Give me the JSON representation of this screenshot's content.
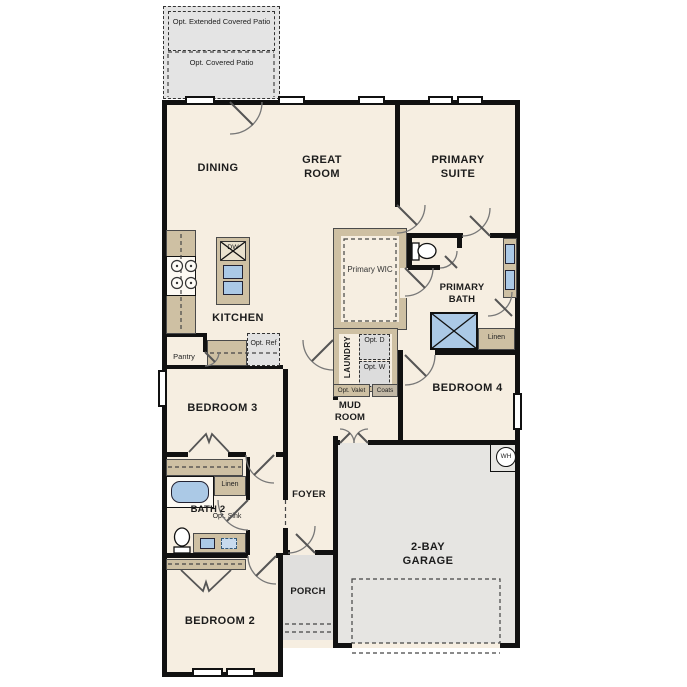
{
  "rooms": {
    "dining": "DINING",
    "great_room": "GREAT ROOM",
    "primary_suite": "PRIMARY SUITE",
    "kitchen": "KITCHEN",
    "primary_wic": "Primary WIC",
    "primary_bath": "PRIMARY BATH",
    "laundry": "LAUNDRY",
    "mud_room": "MUD ROOM",
    "bedroom4": "BEDROOM 4",
    "bedroom3": "BEDROOM 3",
    "bath2": "BATH 2",
    "foyer": "FOYER",
    "porch": "PORCH",
    "bedroom2": "BEDROOM 2",
    "garage": "2-BAY GARAGE",
    "pantry": "Pantry"
  },
  "features": {
    "opt_extended_patio": "Opt. Extended Covered Patio",
    "opt_covered_patio": "Opt. Covered Patio",
    "opt_ref": "Opt. Ref",
    "dw": "DW",
    "opt_d": "Opt. D",
    "opt_w": "Opt. W",
    "opt_valet": "Opt. Valet",
    "coats": "Coats",
    "linen_primary": "Linen",
    "linen_bath2": "Linen",
    "opt_sink": "Opt. Sink",
    "wh": "WH"
  },
  "colors": {
    "floor": "#f6eee1",
    "wall": "#111111",
    "patio_gray": "#e4e4e4",
    "garage_gray": "#e6e5e2",
    "porch_gray": "#e0dfdd",
    "cabinet_tan": "#cec0a3",
    "fixture_blue": "#abc9e6"
  }
}
